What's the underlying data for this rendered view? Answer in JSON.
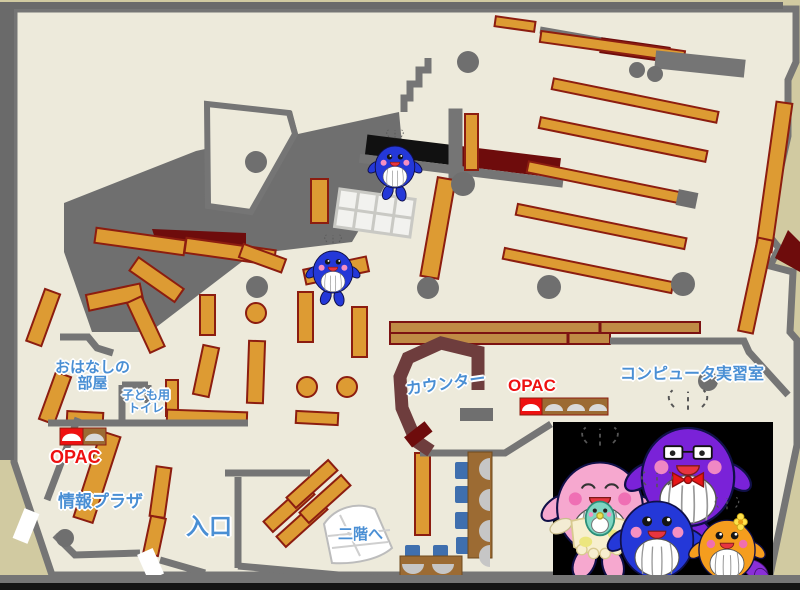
{
  "labels": {
    "ohanashi_room": {
      "line1": "おはなしの",
      "line2": "部屋"
    },
    "kids_toilet": {
      "line1": "子ども用",
      "line2": "トイレ"
    },
    "opac_left": "OPAC",
    "joho_plaza": "情報プラザ",
    "entrance": "入口",
    "stairs_up": "二階へ",
    "counter": "カウンター",
    "opac_right": "OPAC",
    "computer_room": "コンピュータ実習室"
  },
  "colors": {
    "background": "#d1caa1",
    "floor": "#edeadb",
    "wall": "#757575",
    "void_gray": "#6f6f6f",
    "shelf_orange": "#dd9b33",
    "shelf_border": "#8c1d10",
    "counter_brown": "#6e3d3d",
    "desk_brown": "#9c6b33",
    "chair_blue": "#3f6fae",
    "maroon": "#6e0c0c",
    "label_blue": "#4a8fd4",
    "accent_red": "#ee1111",
    "photo_background": "#000000",
    "whale_blue": "#2438d8",
    "whale_pink": "#f6a8cf",
    "whale_purple": "#7a22d8",
    "whale_orange": "#f59d1e",
    "whale_baby_teal": "#7fd6c2"
  },
  "icons": {
    "opac_left_station": "opac-terminal",
    "opac_right_station": "opac-terminal-row",
    "stairs": "spiral-stairs",
    "map_mascots": [
      "blue-whale-mascot",
      "blue-whale-mascot"
    ],
    "family_photo_mascots": [
      "pink-whale-mascot",
      "baby-whale-mascot",
      "purple-whale-mascot",
      "blue-whale-mascot",
      "orange-whale-mascot"
    ]
  }
}
